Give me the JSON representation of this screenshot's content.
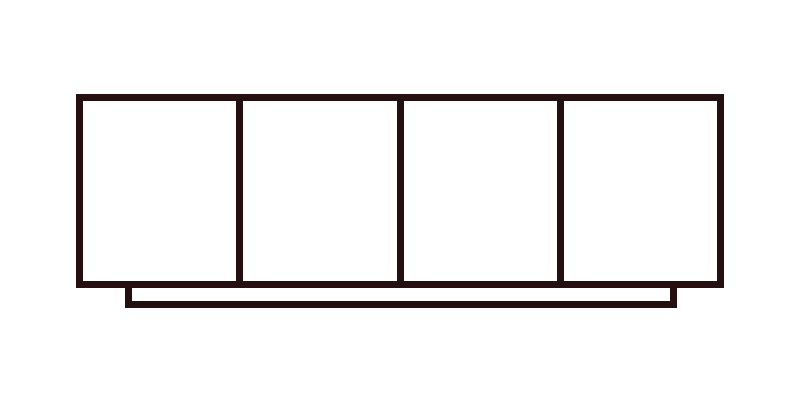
{
  "canvas": {
    "width": 800,
    "height": 400,
    "background": "#ffffff"
  },
  "figure": {
    "kind": "sideboard-front-elevation-line-drawing",
    "stroke_color": "#26100f",
    "stroke_width": 7,
    "body": {
      "x": 76,
      "y": 94,
      "width": 648,
      "height": 194
    },
    "doors": {
      "count": 4
    },
    "plinth": {
      "x": 125,
      "y": 288,
      "width": 552,
      "height": 20
    }
  }
}
